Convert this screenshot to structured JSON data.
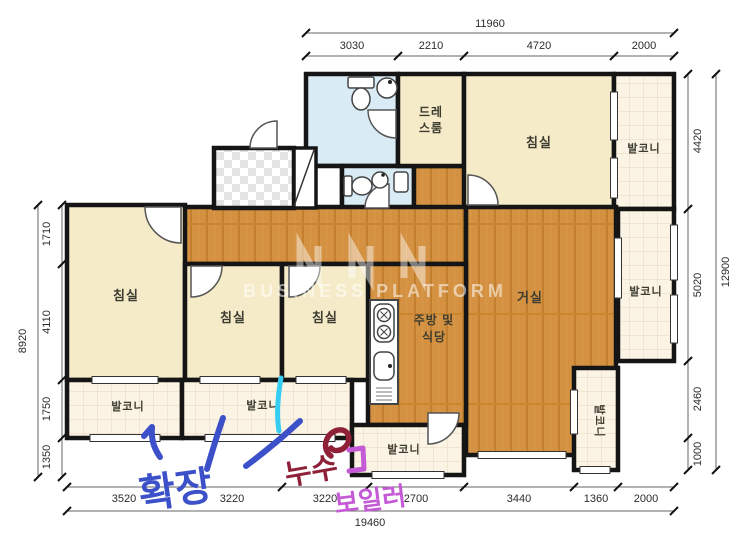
{
  "plan": {
    "watermark": "BUSINESS PLATFORM",
    "rooms": {
      "bedroom_top": "침실",
      "bedroom_left": "침실",
      "bedroom_mid": "침실",
      "bedroom_small": "침실",
      "living": "거실",
      "kitchen_l1": "주방 및",
      "kitchen_l2": "식당",
      "dress_l1": "드레",
      "dress_l2": "스룸",
      "balcony_top": "발코니",
      "balcony_right": "발코니",
      "balcony_a": "발코니",
      "balcony_b": "발코니",
      "balcony_c": "발코니",
      "balcony_d": "발코니"
    },
    "dims": {
      "top_total": "11960",
      "top": [
        "3030",
        "2210",
        "4720",
        "2000"
      ],
      "right": [
        "4420",
        "5020",
        "2460",
        "1000"
      ],
      "right_total": "12900",
      "left": [
        "1710",
        "4110",
        "1750",
        "1350"
      ],
      "left_total": "8920",
      "bottom": [
        "3520",
        "3220",
        "3220",
        "2700",
        "3440",
        "1360",
        "2000"
      ],
      "bottom_total": "19460"
    },
    "annotations": {
      "expansion": "확장",
      "leak": "누수",
      "boiler": "보일러"
    },
    "colors": {
      "wall": "#151515",
      "wood_floor": "#d49141",
      "room_cream": "#f5ebc8",
      "bath_blue": "#d9ebf5",
      "balcony_tile": "#fbf3e3",
      "ink_blue": "#3b50c9",
      "ink_cyan": "#35cdf2",
      "ink_maroon": "#8e2038",
      "ink_magenta": "#c55ad6"
    }
  }
}
